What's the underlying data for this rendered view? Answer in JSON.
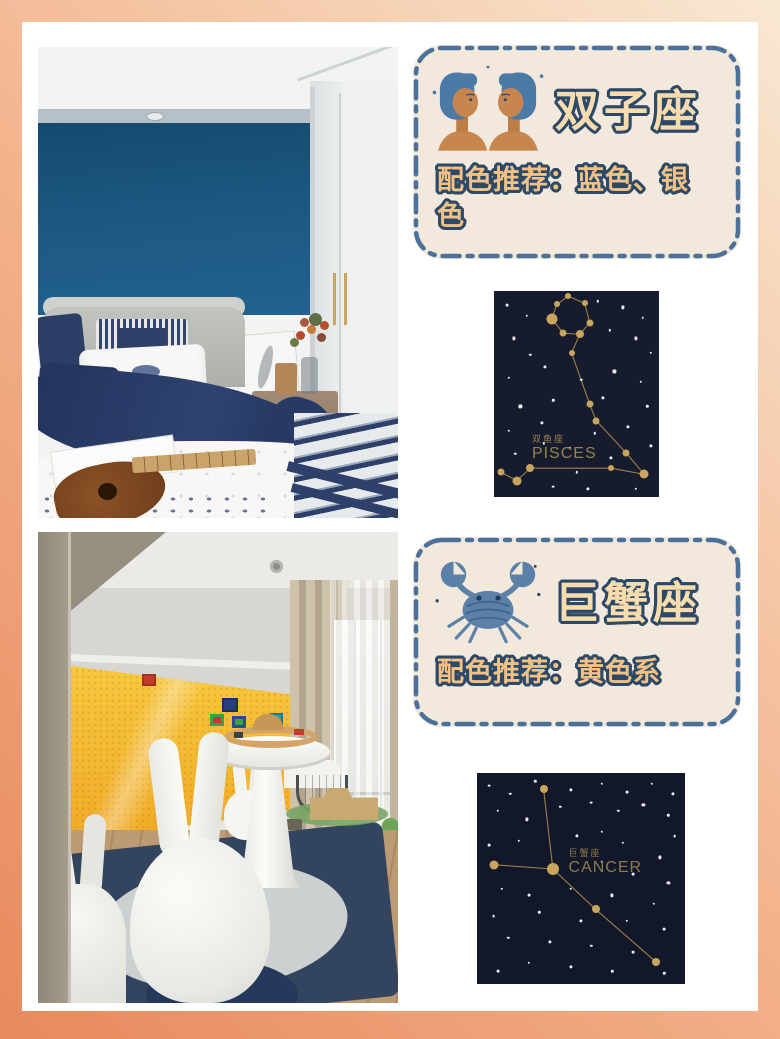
{
  "palette": {
    "frame_top": "#f8e8d3",
    "frame_mid": "#f3b28b",
    "frame_bottom": "#e8895e",
    "canvas_bg": "#ffffff",
    "card_bg": "#f2e9dc",
    "card_border": "#4b719a",
    "title_fill": "#f8dcae",
    "subtitle_fill": "#f1c186",
    "text_outline": "#2c4967",
    "bedroom_accent_wall": "#1d5a83",
    "playroom_accent_wall": "#f5b92e"
  },
  "cards": [
    {
      "id": "gemini",
      "title": "双子座",
      "subtitle": "配色推荐：蓝色、银色",
      "icon": "gemini-twins-icon"
    },
    {
      "id": "cancer",
      "title": "巨蟹座",
      "subtitle": "配色推荐：黄色系",
      "icon": "cancer-crab-icon"
    }
  ],
  "photos": [
    {
      "id": "bedroom",
      "name": "blue-bedroom-photo"
    },
    {
      "id": "playroom",
      "name": "yellow-playroom-photo"
    }
  ],
  "constellations": [
    {
      "id": "pisces",
      "label_cn": "双鱼座",
      "label_en": "PISCES",
      "bg": "#161c2e",
      "star_color": "#c8a45c",
      "line_color": "#9a8148",
      "label_color": "#98824f",
      "label_pos": {
        "x": 23,
        "y": 70
      },
      "stars": [
        [
          45,
          2.5,
          3
        ],
        [
          55,
          6,
          3
        ],
        [
          58,
          15.5,
          3.5
        ],
        [
          52,
          21,
          4
        ],
        [
          42,
          20.5,
          3.5
        ],
        [
          35,
          13.5,
          5.5
        ],
        [
          38,
          6.5,
          3
        ],
        [
          47,
          30,
          3
        ],
        [
          58,
          55,
          3.5
        ],
        [
          62,
          63,
          3.5
        ],
        [
          80,
          78.5,
          3.5
        ],
        [
          91,
          89,
          4.5
        ],
        [
          71,
          86,
          3
        ],
        [
          22,
          86,
          4
        ],
        [
          14,
          92,
          4.5
        ],
        [
          4,
          88,
          3.5
        ]
      ],
      "segments": [
        [
          0,
          1
        ],
        [
          1,
          2
        ],
        [
          2,
          3
        ],
        [
          3,
          4
        ],
        [
          4,
          5
        ],
        [
          5,
          6
        ],
        [
          6,
          0
        ],
        [
          3,
          7
        ],
        [
          7,
          8
        ],
        [
          8,
          9
        ],
        [
          9,
          10
        ],
        [
          10,
          11
        ],
        [
          11,
          12
        ],
        [
          12,
          13
        ],
        [
          13,
          14
        ],
        [
          14,
          15
        ]
      ],
      "bg_stars": [
        [
          8,
          7,
          1.4
        ],
        [
          20,
          12,
          1.2
        ],
        [
          63,
          5,
          1.2
        ],
        [
          78,
          8,
          1.6
        ],
        [
          90,
          13,
          1.2
        ],
        [
          70,
          19,
          1.2
        ],
        [
          86,
          23,
          1.6
        ],
        [
          95,
          30,
          1.2
        ],
        [
          12,
          23,
          1.6
        ],
        [
          22,
          31,
          1.2
        ],
        [
          31,
          37,
          1.6
        ],
        [
          9,
          42,
          1.2
        ],
        [
          53,
          43,
          1.2
        ],
        [
          73,
          39,
          1.6
        ],
        [
          89,
          44,
          1.2
        ],
        [
          16,
          56,
          1.6
        ],
        [
          36,
          53,
          1.2
        ],
        [
          66,
          52,
          1.6
        ],
        [
          93,
          56,
          1.2
        ],
        [
          9,
          68,
          1.2
        ],
        [
          29,
          64,
          1.6
        ],
        [
          61,
          69,
          1.2
        ],
        [
          81,
          66,
          1.6
        ],
        [
          46,
          76,
          1.2
        ],
        [
          71,
          81,
          1.6
        ],
        [
          36,
          95,
          1.4
        ],
        [
          57,
          96,
          1.6
        ],
        [
          86,
          96,
          1.2
        ],
        [
          13,
          79,
          1.2
        ],
        [
          95,
          75,
          1.6
        ],
        [
          50,
          88,
          1.2
        ],
        [
          30,
          74,
          1.2
        ]
      ]
    },
    {
      "id": "cancer",
      "label_cn": "巨蟹座",
      "label_en": "CANCER",
      "bg": "#121829",
      "star_color": "#c8a45c",
      "line_color": "#9a8148",
      "label_color": "#8d7a4c",
      "label_pos": {
        "x": 44,
        "y": 36
      },
      "stars": [
        [
          32,
          7.7,
          4
        ],
        [
          36.5,
          45.5,
          6
        ],
        [
          8.2,
          43.5,
          4.5
        ],
        [
          57,
          64.6,
          4
        ],
        [
          86,
          89.5,
          4
        ]
      ],
      "segments": [
        [
          0,
          1
        ],
        [
          2,
          1
        ],
        [
          1,
          3
        ],
        [
          3,
          4
        ]
      ],
      "bg_stars": [
        [
          6,
          6,
          1.4
        ],
        [
          16,
          10,
          1.2
        ],
        [
          28,
          4,
          1.2
        ],
        [
          45,
          8,
          1.6
        ],
        [
          60,
          5,
          1.2
        ],
        [
          72,
          9,
          1.4
        ],
        [
          84,
          5,
          1.2
        ],
        [
          94,
          10,
          1.6
        ],
        [
          10,
          18,
          1.2
        ],
        [
          24,
          22,
          1.6
        ],
        [
          40,
          16,
          1.2
        ],
        [
          55,
          14,
          1.4
        ],
        [
          68,
          18,
          1.2
        ],
        [
          80,
          15,
          1.6
        ],
        [
          92,
          20,
          1.2
        ],
        [
          95,
          30,
          1.4
        ],
        [
          60,
          28,
          1.2
        ],
        [
          48,
          30,
          1.6
        ],
        [
          20,
          32,
          1.2
        ],
        [
          6,
          34,
          1.4
        ],
        [
          70,
          33,
          1.2
        ],
        [
          88,
          40,
          1.6
        ],
        [
          60,
          42,
          1.2
        ],
        [
          75,
          48,
          1.4
        ],
        [
          92,
          52,
          1.6
        ],
        [
          12,
          55,
          1.2
        ],
        [
          25,
          58,
          1.4
        ],
        [
          45,
          55,
          1.2
        ],
        [
          65,
          58,
          1.6
        ],
        [
          85,
          62,
          1.2
        ],
        [
          8,
          68,
          1.4
        ],
        [
          30,
          66,
          1.2
        ],
        [
          50,
          70,
          1.6
        ],
        [
          72,
          70,
          1.2
        ],
        [
          90,
          74,
          1.4
        ],
        [
          15,
          78,
          1.2
        ],
        [
          35,
          80,
          1.6
        ],
        [
          55,
          82,
          1.2
        ],
        [
          75,
          85,
          1.4
        ],
        [
          25,
          90,
          1.2
        ],
        [
          45,
          92,
          1.6
        ],
        [
          65,
          94,
          1.2
        ],
        [
          10,
          94,
          1.4
        ],
        [
          90,
          95,
          1.2
        ]
      ]
    }
  ]
}
